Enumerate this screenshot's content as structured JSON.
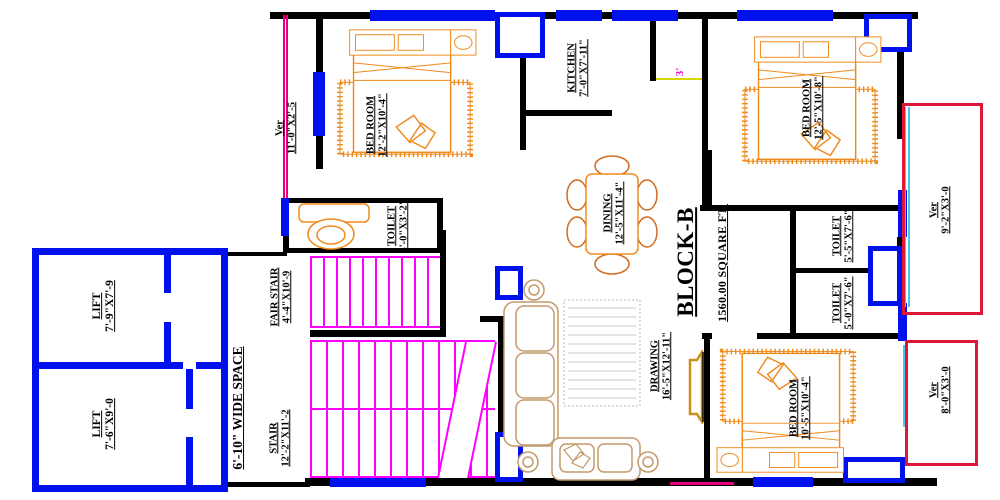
{
  "plan": {
    "block": {
      "name": "BLOCK-B",
      "area": "1560.00 SQUARE FT."
    },
    "rooms": {
      "ver_top": {
        "name": "Ver",
        "dim": "11'-0\"X2'-5"
      },
      "bed_tl": {
        "name": "BED ROOM",
        "dim": "12'-2\"X10'-4\""
      },
      "kitchen": {
        "name": "KITCHEN",
        "dim": "7'-0\"X7'-11\""
      },
      "bed_tr": {
        "name": "BED ROOM",
        "dim": "12'-5\"X10'-8\""
      },
      "ver_right": {
        "name": "Ver",
        "dim": "9'-2\"X3'-0"
      },
      "toilet_mid": {
        "name": "TOILET",
        "dim": "4'-0\"X3'-2\""
      },
      "toilet_r1": {
        "name": "TOILET",
        "dim": "5'-5\"X7'-6\""
      },
      "toilet_r2": {
        "name": "TOILET",
        "dim": "5'-0\"X7'-6\""
      },
      "dining": {
        "name": "DINING",
        "dim": "12'-5\"X11'-4\""
      },
      "drawing": {
        "name": "DRAWING",
        "dim": "16'-5\"X12'-11\""
      },
      "bed_b": {
        "name": "BED ROOM",
        "dim": "10'-5\"X10'-4\""
      },
      "ver_bottom": {
        "name": "Ver",
        "dim": "8'-0\"X3'-0"
      },
      "lift1": {
        "name": "LIFT",
        "dim": "7'-9\"X7'-9"
      },
      "lift2": {
        "name": "LIFT",
        "dim": "7'-6\"X9'-0"
      },
      "fair_stair": {
        "name": "FAIR STAIR",
        "dim": "4'-4\"X10'-9"
      },
      "stair": {
        "name": "STAIR",
        "dim": "12'-2\"X11'-2"
      },
      "wide_space": {
        "name": "6'-10\" WIDE SPACE"
      }
    },
    "dims": {
      "door": "3'"
    },
    "colors": {
      "wall": "#000000",
      "window": "#0011ee",
      "stair_tread": "#ff00ff",
      "verandah_line": "#e8007d",
      "verandah_outline": "#de1638",
      "glass": "#45c6ea",
      "furniture": "#ef8b1d",
      "sofa": "#c49a6c",
      "rug": "#c8c8c8",
      "dim_text": "#ff00cc",
      "dim_line": "#d6d600"
    }
  }
}
